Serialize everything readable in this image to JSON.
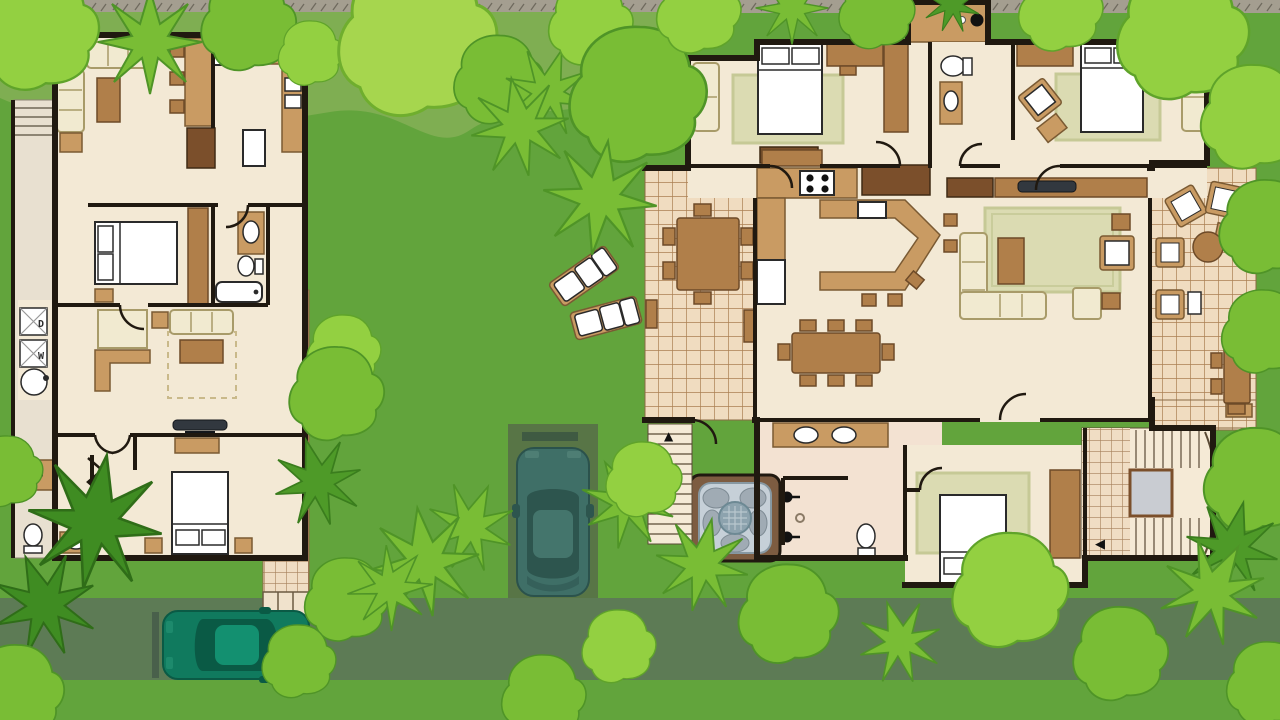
{
  "scene": {
    "title": "Tropical resort villas site plan",
    "description": "Top-down illustrated floor plan of two villas on a green landscaped lot with trees, palms, a street, a driveway with a parked car and tiled walkways",
    "view": "overhead-2d-floorplan"
  },
  "palette": {
    "grass": "#62a43c",
    "grass_light_band": "#7fae52",
    "ground_strip": "#a49e90",
    "road": "#5d7b55",
    "driveway": "#587546",
    "tree_light": "#93d041",
    "tree_mid": "#79bd35",
    "tree_dark": "#4e9a28",
    "palm_dark": "#3f8c22",
    "wall": "#201910",
    "floor": "#f3e9d5",
    "porch": "#e8e0d0",
    "deck_tile": "#f0dcc0",
    "deck_tile_line": "#aa7f52",
    "wood_light": "#c99b63",
    "wood_mid": "#b07f4a",
    "wood_dark": "#7b4f2b",
    "cream_furniture": "#f1ead0",
    "rug_green": "#dbdbb2",
    "fixture_white": "#ffffff",
    "hot_tub_water": "#c6d0d8",
    "tv_screen": "#32383f",
    "car_teal": "#3f6f67",
    "car_green": "#107a5e"
  },
  "left_house": {
    "name": "guest villa",
    "rooms": [
      "living room",
      "kitchen",
      "master bedroom",
      "bathroom",
      "laundry",
      "tv lounge",
      "second bedroom",
      "second bathroom",
      "entry closet",
      "side porch"
    ],
    "furniture": [
      "two sofas",
      "armchair",
      "coffee tables",
      "breakfast bar with 3 stools",
      "stove",
      "fridge",
      "double sink",
      "double bed",
      "wardrobe",
      "vanity",
      "toilet",
      "bathtub",
      "washer",
      "dryer",
      "round laundry sink",
      "wall tv",
      "dresser",
      "second double bed",
      "nightstands",
      "bifold closet"
    ],
    "laundry": {
      "washer_label": "W",
      "dryer_label": "D"
    }
  },
  "right_house": {
    "name": "main villa",
    "rooms": [
      "bedroom 1",
      "bathroom 1",
      "outdoor wash area",
      "bedroom 2",
      "hallway",
      "kitchen",
      "dining room",
      "living room",
      "west deck",
      "east deck",
      "lower bathroom",
      "shower room",
      "bedroom 3",
      "stair hall"
    ],
    "furniture": [
      "three double beds",
      "area rugs",
      "loveseats",
      "angled armchairs",
      "desks",
      "wardrobes",
      "media wall with tv",
      "sectional sofa",
      "coffee table",
      "dining table for 8",
      "outdoor dining tables",
      "kitchen island with stools",
      "stove",
      "fridge",
      "double-sink vanity",
      "toilets",
      "hot tub",
      "lounge chairs",
      "round patio table"
    ],
    "features": [
      "hot tub / jacuzzi",
      "two tiled decks",
      "u-shaped staircase",
      "outdoor steps with up arrow"
    ]
  },
  "landscape": {
    "trees": "stylized round canopies and star-shaped palms in three greens",
    "walkway": "tiled path from guest villa to street with steps",
    "sun_loungers": 2,
    "street": "olive-green road along bottom",
    "driveway": "dark green pad with parked car"
  },
  "vehicles": [
    {
      "name": "teal car",
      "location": "driveway",
      "color": "#3f6f67"
    },
    {
      "name": "green car",
      "location": "street parking",
      "color": "#107a5e"
    }
  ],
  "glyphs": {
    "stairs_up": "▲",
    "stairs_turn": "◀"
  }
}
